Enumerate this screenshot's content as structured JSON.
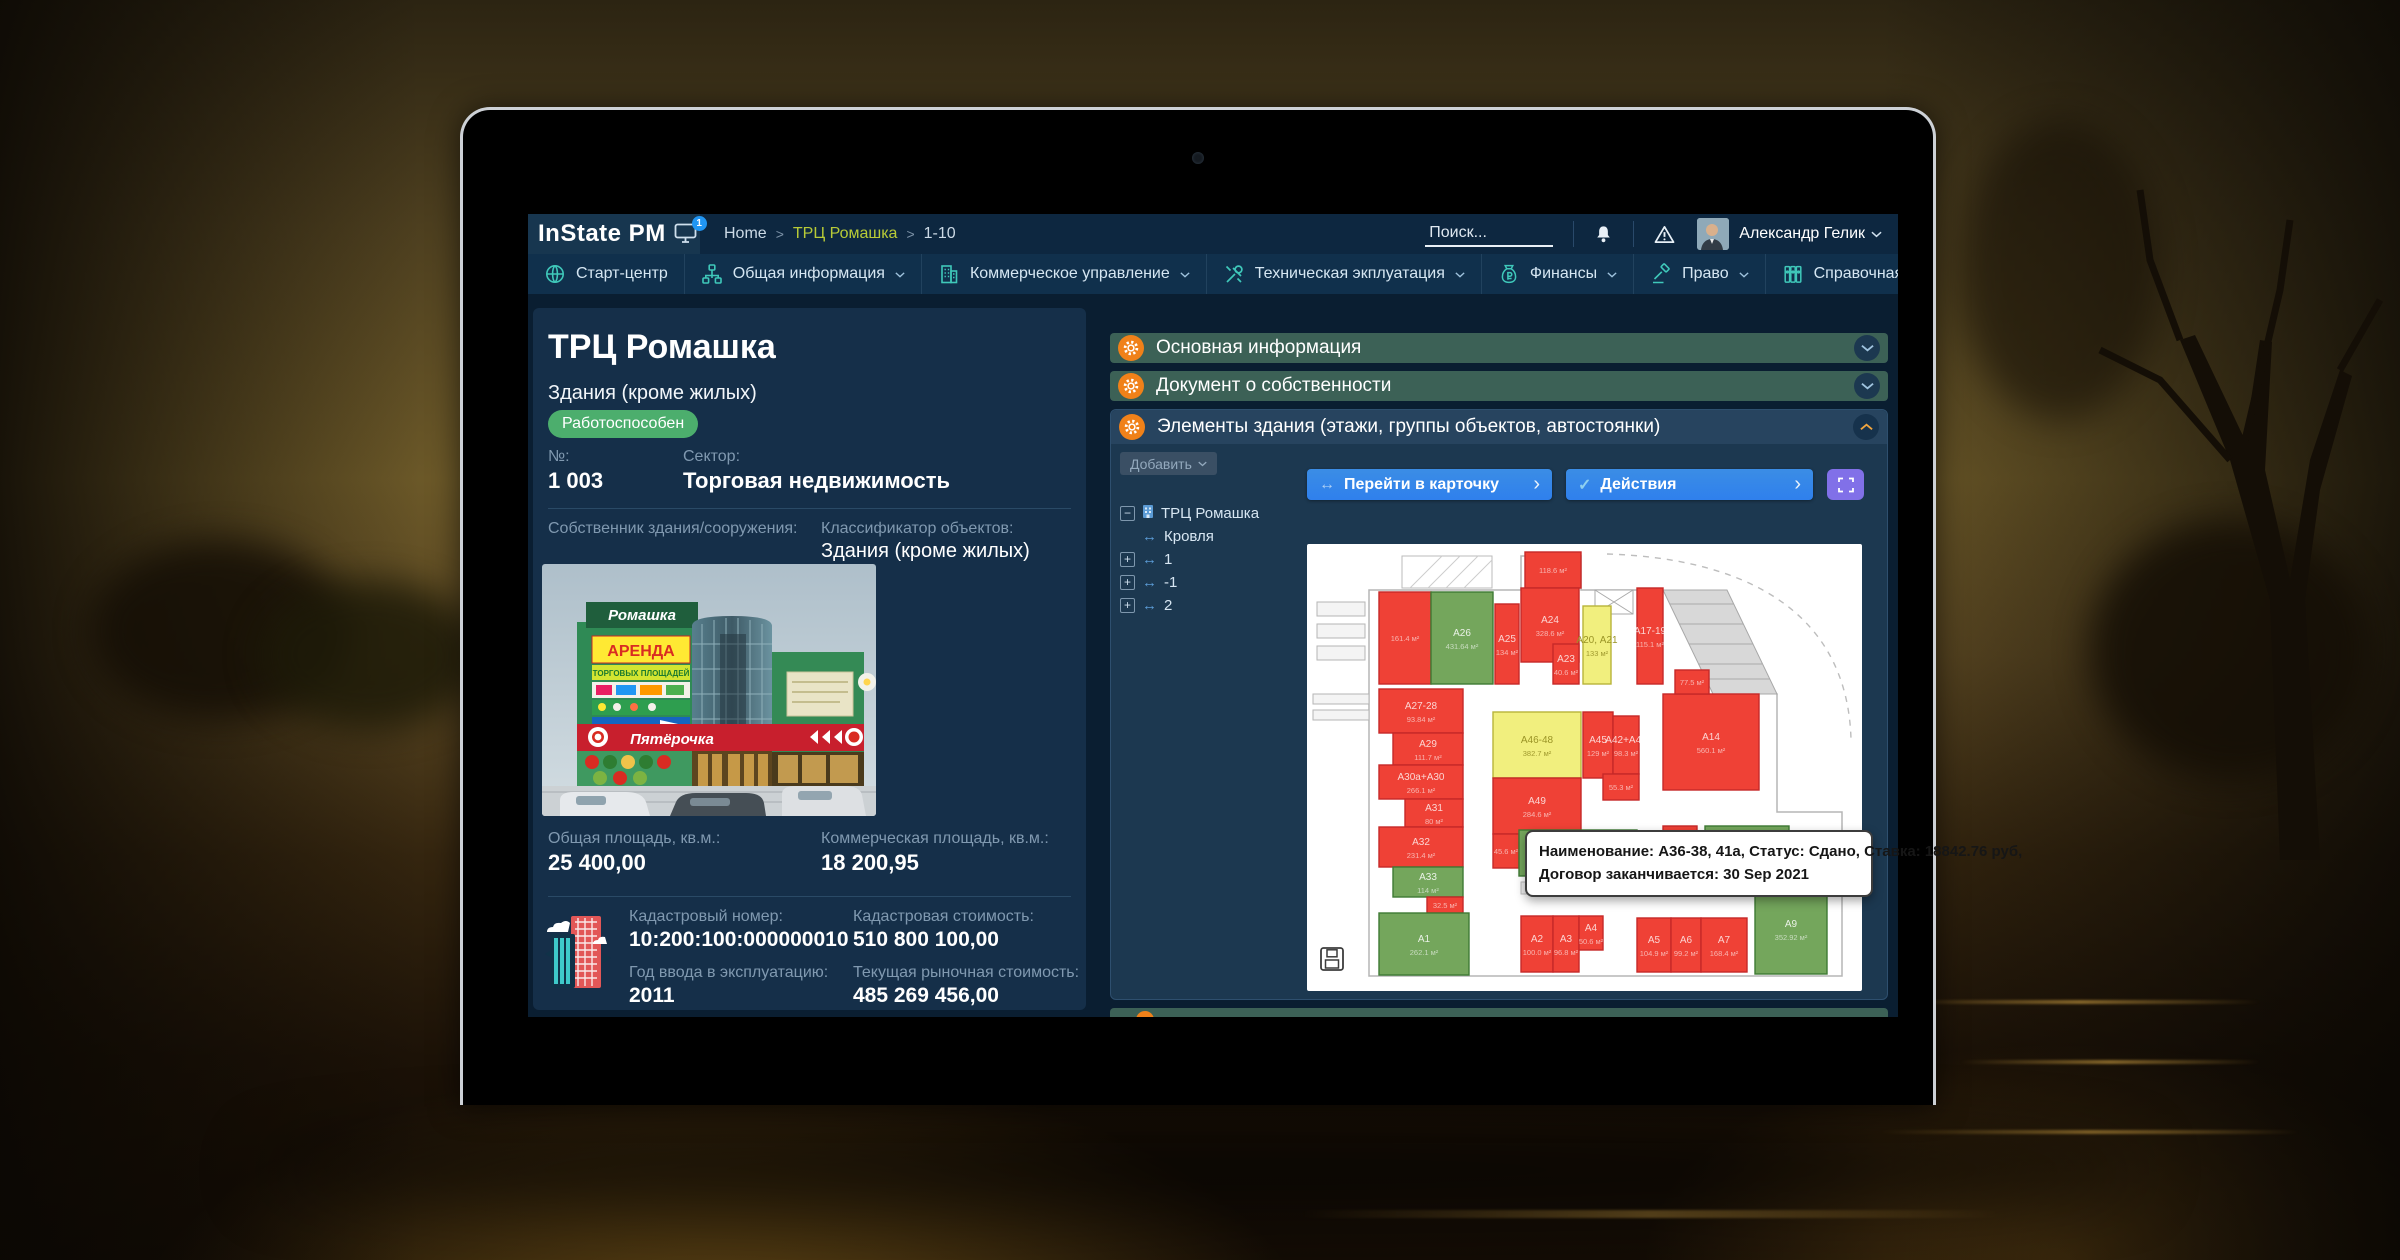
{
  "topbar": {
    "logo": "InState PM",
    "logo_badge": "1",
    "breadcrumb": [
      {
        "label": "Home",
        "accent": false
      },
      {
        "label": "ТРЦ Ромашка",
        "accent": true
      },
      {
        "label": "1-10",
        "accent": false
      }
    ],
    "search_placeholder": "Поиск...",
    "user_name": "Александр Гелик"
  },
  "nav": {
    "items": [
      {
        "label": "Старт-центр",
        "icon": "globe",
        "caret": false
      },
      {
        "label": "Общая информация",
        "icon": "sitemap",
        "caret": true
      },
      {
        "label": "Коммерческое управление",
        "icon": "building",
        "caret": true
      },
      {
        "label": "Техническая экплуатация",
        "icon": "tools",
        "caret": true
      },
      {
        "label": "Финансы",
        "icon": "moneybag",
        "caret": true
      },
      {
        "label": "Право",
        "icon": "gavel",
        "caret": true
      },
      {
        "label": "Справочная информация",
        "icon": "books",
        "caret": true
      },
      {
        "label": "Дебиторская задолженность",
        "icon": "moneybag",
        "caret": true
      },
      {
        "label": "",
        "icon": "globe-solid",
        "caret": false
      }
    ]
  },
  "property": {
    "title": "ТРЦ Ромашка",
    "subtitle": "Здания (кроме жилых)",
    "status": "Работоспособен",
    "number_label": "№:",
    "number": "1 003",
    "sector_label": "Сектор:",
    "sector": "Торговая недвижимость",
    "owner_label": "Собственник здания/сооружения:",
    "classifier_label": "Классификатор объектов:",
    "classifier": "Здания (кроме жилых)",
    "total_area_label": "Общая площадь, кв.м.:",
    "total_area": "25 400,00",
    "commercial_area_label": "Коммерческая площадь, кв.м.:",
    "commercial_area": "18 200,95",
    "cadastral_number_label": "Кадастровый номер:",
    "cadastral_number": "10:200:100:000000010",
    "cadastral_value_label": "Кадастровая стоимость:",
    "cadastral_value": "510 800 100,00",
    "year_label": "Год ввода в эксплуатацию:",
    "year": "2011",
    "market_value_label": "Текущая рыночная стоимость:",
    "market_value": "485 269 456,00",
    "photo_signs": {
      "roof": "Ромашка",
      "banner1": "АРЕНДА",
      "banner2": "ТОРГОВЫХ ПЛОЩАДЕЙ",
      "store": "Пятёрочка"
    }
  },
  "sections": [
    {
      "label": "Основная информация",
      "state": "collapsed"
    },
    {
      "label": "Документ о собственности",
      "state": "collapsed"
    },
    {
      "label": "Элементы здания (этажи, группы объектов, автостоянки)",
      "state": "expanded"
    }
  ],
  "elements": {
    "add_button": "Добавить",
    "tree": [
      {
        "label": "ТРЦ Ромашка",
        "expander": "minus",
        "icon": "building",
        "indent": 0
      },
      {
        "label": "Кровля",
        "expander": "",
        "icon": "arrows",
        "indent": 1
      },
      {
        "label": "1",
        "expander": "plus",
        "icon": "arrows",
        "indent": 1
      },
      {
        "label": "-1",
        "expander": "plus",
        "icon": "arrows",
        "indent": 1
      },
      {
        "label": "2",
        "expander": "plus",
        "icon": "arrows",
        "indent": 1
      }
    ],
    "goto_button": "Перейти в карточку",
    "actions_button": "Действия",
    "tooltip_line1": "Наименование: А36-38, 41а, Статус: Сдано, Ставка: 18842.76 руб,",
    "tooltip_line2": "Договор заканчивается: 30 Sep 2021"
  },
  "plan": {
    "rooms": [
      {
        "label": "",
        "area": "118.6 м²",
        "color": "red",
        "x": 218,
        "y": 8,
        "w": 56,
        "h": 36
      },
      {
        "label": "",
        "area": "161.4 м²",
        "color": "red",
        "x": 72,
        "y": 48,
        "w": 52,
        "h": 92
      },
      {
        "label": "А26",
        "area": "431.64 м²",
        "color": "green",
        "x": 124,
        "y": 48,
        "w": 62,
        "h": 92
      },
      {
        "label": "А25",
        "area": "134 м²",
        "color": "red",
        "x": 188,
        "y": 60,
        "w": 24,
        "h": 80
      },
      {
        "label": "А24",
        "area": "328.6 м²",
        "color": "red",
        "x": 214,
        "y": 44,
        "w": 58,
        "h": 74
      },
      {
        "label": "А23",
        "area": "40.6 м²",
        "color": "red",
        "x": 246,
        "y": 100,
        "w": 26,
        "h": 40
      },
      {
        "label": "А20, А21",
        "area": "133 м²",
        "color": "yellow",
        "x": 276,
        "y": 62,
        "w": 28,
        "h": 78
      },
      {
        "label": "А17-19",
        "area": "115.1 м²",
        "color": "red",
        "x": 330,
        "y": 44,
        "w": 26,
        "h": 96
      },
      {
        "label": "А27-28",
        "area": "93.84 м²",
        "color": "red",
        "x": 72,
        "y": 145,
        "w": 84,
        "h": 44
      },
      {
        "label": "А29",
        "area": "111.7 м²",
        "color": "red",
        "x": 86,
        "y": 189,
        "w": 70,
        "h": 32
      },
      {
        "label": "А30а+А30",
        "area": "266.1 м²",
        "color": "red",
        "x": 72,
        "y": 221,
        "w": 84,
        "h": 34
      },
      {
        "label": "А31",
        "area": "80 м²",
        "color": "red",
        "x": 98,
        "y": 255,
        "w": 58,
        "h": 28
      },
      {
        "label": "А32",
        "area": "231.4 м²",
        "color": "red",
        "x": 72,
        "y": 283,
        "w": 84,
        "h": 40
      },
      {
        "label": "А33",
        "area": "114 м²",
        "color": "green",
        "x": 86,
        "y": 323,
        "w": 70,
        "h": 30
      },
      {
        "label": "",
        "area": "32.5 м²",
        "color": "red",
        "x": 120,
        "y": 353,
        "w": 36,
        "h": 16
      },
      {
        "label": "А1",
        "area": "262.1 м²",
        "color": "green",
        "x": 72,
        "y": 369,
        "w": 90,
        "h": 62
      },
      {
        "label": "А46-48",
        "area": "382.7 м²",
        "color": "yellow",
        "x": 186,
        "y": 168,
        "w": 88,
        "h": 66
      },
      {
        "label": "А49",
        "area": "284.6 м²",
        "color": "red",
        "x": 186,
        "y": 234,
        "w": 88,
        "h": 56
      },
      {
        "label": "А45",
        "area": "129 м²",
        "color": "red",
        "x": 276,
        "y": 168,
        "w": 30,
        "h": 66
      },
      {
        "label": "А42+А43",
        "area": "98.3 м²",
        "color": "red",
        "x": 306,
        "y": 172,
        "w": 26,
        "h": 58
      },
      {
        "label": "",
        "area": "55.3 м²",
        "color": "red",
        "x": 296,
        "y": 230,
        "w": 36,
        "h": 26
      },
      {
        "label": "",
        "area": "45.6 м²",
        "color": "red",
        "x": 186,
        "y": 290,
        "w": 26,
        "h": 34
      },
      {
        "label": "А36-38,41а",
        "area": "",
        "color": "green",
        "x": 212,
        "y": 286,
        "w": 118,
        "h": 46
      },
      {
        "label": "А40",
        "area": "42.6 м²",
        "color": "green",
        "x": 300,
        "y": 288,
        "w": 30,
        "h": 28
      },
      {
        "label": "А14",
        "area": "560.1 м²",
        "color": "red",
        "x": 356,
        "y": 150,
        "w": 96,
        "h": 96
      },
      {
        "label": "",
        "area": "77.5 м²",
        "color": "red",
        "x": 368,
        "y": 126,
        "w": 34,
        "h": 24
      },
      {
        "label": "",
        "area": "47.9 м²",
        "color": "red",
        "x": 356,
        "y": 282,
        "w": 34,
        "h": 34
      },
      {
        "label": "R1",
        "area": "",
        "color": "green",
        "x": 398,
        "y": 282,
        "w": 84,
        "h": 38
      },
      {
        "label": "А2",
        "area": "100.0 м²",
        "color": "red",
        "x": 214,
        "y": 372,
        "w": 32,
        "h": 56
      },
      {
        "label": "А3",
        "area": "96.8 м²",
        "color": "red",
        "x": 246,
        "y": 372,
        "w": 26,
        "h": 56
      },
      {
        "label": "А4",
        "area": "50.6 м²",
        "color": "red",
        "x": 272,
        "y": 372,
        "w": 24,
        "h": 34
      },
      {
        "label": "А5",
        "area": "104.9 м²",
        "color": "red",
        "x": 330,
        "y": 374,
        "w": 34,
        "h": 54
      },
      {
        "label": "А6",
        "area": "99.2 м²",
        "color": "red",
        "x": 364,
        "y": 374,
        "w": 30,
        "h": 54
      },
      {
        "label": "А7",
        "area": "168.4 м²",
        "color": "red",
        "x": 394,
        "y": 374,
        "w": 46,
        "h": 54
      },
      {
        "label": "А9",
        "area": "352.92 м²",
        "color": "green",
        "x": 448,
        "y": 340,
        "w": 72,
        "h": 90
      }
    ]
  },
  "colors": {
    "accent_orange": "#f08119",
    "accent_teal": "#3fc8ba",
    "status_green": "#4cae6d",
    "button_blue": "#2f80ed",
    "button_purple": "#8170e8",
    "breadcrumb_accent": "#b8cb37",
    "room_red": "#ef4136",
    "room_green": "#74a65c",
    "room_yellow": "#f1ef7e"
  }
}
